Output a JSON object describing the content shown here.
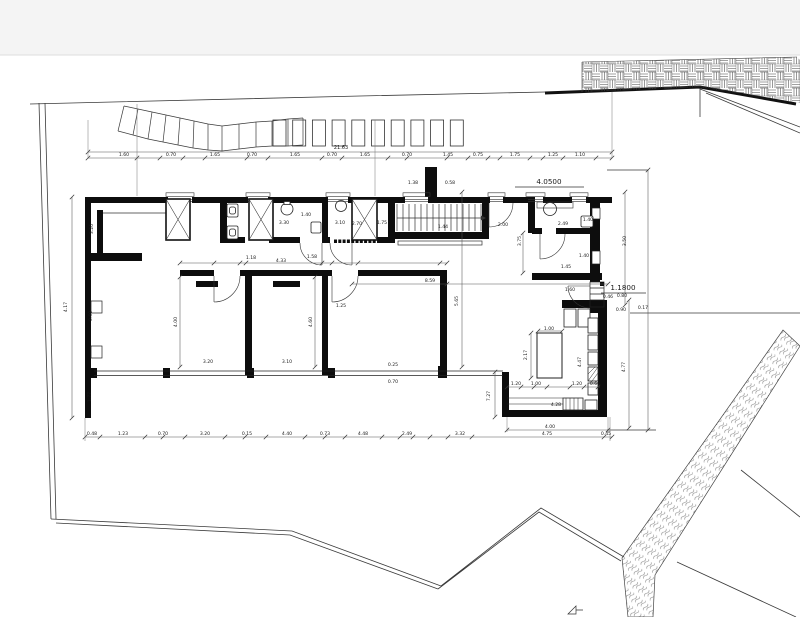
{
  "page": {
    "background": "#ffffff",
    "top_margin_color": "#f4f4f4"
  },
  "drawing": {
    "colors": {
      "wall_ink": "#0d0d0d",
      "thin_line": "#3a3a3a",
      "dim_line": "#555555",
      "hatch": "#666666"
    },
    "level_labels": [
      {
        "text": "4.0500",
        "x": 549,
        "y": 184
      },
      {
        "text": "1.1800",
        "x": 623,
        "y": 290
      }
    ],
    "overall_dimension": {
      "text": "21.63",
      "x": 341,
      "y": 149
    },
    "top_chain": {
      "y": 156,
      "labels": [
        {
          "x": 124,
          "t": "1.60"
        },
        {
          "x": 171,
          "t": "0.70"
        },
        {
          "x": 215,
          "t": "1.65"
        },
        {
          "x": 252,
          "t": "0.70"
        },
        {
          "x": 295,
          "t": "1.65"
        },
        {
          "x": 332,
          "t": "0.70"
        },
        {
          "x": 365,
          "t": "1.65"
        },
        {
          "x": 407,
          "t": "0.70"
        },
        {
          "x": 448,
          "t": "1.45"
        },
        {
          "x": 478,
          "t": "0.75"
        },
        {
          "x": 515,
          "t": "1.75"
        },
        {
          "x": 553,
          "t": "1.25"
        },
        {
          "x": 580,
          "t": "1.10"
        }
      ]
    },
    "bottom_chain": {
      "y": 435,
      "labels": [
        {
          "x": 92,
          "t": "0.48"
        },
        {
          "x": 123,
          "t": "1.23"
        },
        {
          "x": 163,
          "t": "0.70"
        },
        {
          "x": 205,
          "t": "3.20"
        },
        {
          "x": 247,
          "t": "0.15"
        },
        {
          "x": 287,
          "t": "4.40"
        },
        {
          "x": 325,
          "t": "0.73"
        },
        {
          "x": 363,
          "t": "4.48"
        },
        {
          "x": 407,
          "t": "2.49"
        },
        {
          "x": 460,
          "t": "3.32"
        },
        {
          "x": 547,
          "t": "4.75"
        },
        {
          "x": 606,
          "t": "0.45"
        }
      ]
    },
    "secondary_bottom_dimension": {
      "text": "4.00",
      "x": 550,
      "y": 428
    },
    "dim_labels": [
      {
        "t": "4.17",
        "x": 67,
        "y": 307,
        "r": -90
      },
      {
        "t": "3.20",
        "x": 93,
        "y": 229,
        "r": -90
      },
      {
        "t": "0.60",
        "x": 92,
        "y": 316,
        "r": -90
      },
      {
        "t": "1.77",
        "x": 91,
        "y": 397,
        "r": -90
      },
      {
        "t": "4.00",
        "x": 177,
        "y": 322,
        "r": -90
      },
      {
        "t": "4.60",
        "x": 312,
        "y": 322,
        "r": -90
      },
      {
        "t": "3.20",
        "x": 208,
        "y": 363
      },
      {
        "t": "3.10",
        "x": 287,
        "y": 363
      },
      {
        "t": "1.25",
        "x": 341,
        "y": 307
      },
      {
        "t": "1.18",
        "x": 251,
        "y": 259
      },
      {
        "t": "4.33",
        "x": 281,
        "y": 262
      },
      {
        "t": "1.58",
        "x": 312,
        "y": 258
      },
      {
        "t": "3.30",
        "x": 284,
        "y": 224
      },
      {
        "t": "3.10",
        "x": 340,
        "y": 224
      },
      {
        "t": "1.40",
        "x": 306,
        "y": 216
      },
      {
        "t": "2.70",
        "x": 357,
        "y": 225
      },
      {
        "t": "1.75",
        "x": 382,
        "y": 224
      },
      {
        "t": "1.44",
        "x": 443,
        "y": 228
      },
      {
        "t": "1.38",
        "x": 413,
        "y": 184
      },
      {
        "t": "0.58",
        "x": 450,
        "y": 184
      },
      {
        "t": "2.00",
        "x": 503,
        "y": 226
      },
      {
        "t": "2.49",
        "x": 563,
        "y": 225
      },
      {
        "t": "1.40",
        "x": 588,
        "y": 221
      },
      {
        "t": "3.75",
        "x": 521,
        "y": 241,
        "r": -90
      },
      {
        "t": "1.45",
        "x": 566,
        "y": 268
      },
      {
        "t": "1.40",
        "x": 584,
        "y": 257
      },
      {
        "t": "3.50",
        "x": 626,
        "y": 241,
        "r": -90
      },
      {
        "t": "1.60",
        "x": 570,
        "y": 291
      },
      {
        "t": "0.46",
        "x": 608,
        "y": 298
      },
      {
        "t": "0.80",
        "x": 622,
        "y": 297
      },
      {
        "t": "0.90",
        "x": 621,
        "y": 311
      },
      {
        "t": "0.17",
        "x": 643,
        "y": 309
      },
      {
        "t": "8.59",
        "x": 430,
        "y": 282
      },
      {
        "t": "5.65",
        "x": 458,
        "y": 301,
        "r": -90
      },
      {
        "t": "7.27",
        "x": 490,
        "y": 396,
        "r": -90
      },
      {
        "t": "4.47",
        "x": 581,
        "y": 362,
        "r": -90
      },
      {
        "t": "4.77",
        "x": 625,
        "y": 367,
        "r": -90
      },
      {
        "t": "1.00",
        "x": 549,
        "y": 330
      },
      {
        "t": "2.17",
        "x": 527,
        "y": 355,
        "r": -90
      },
      {
        "t": "1.20",
        "x": 516,
        "y": 385
      },
      {
        "t": "1.00",
        "x": 536,
        "y": 385
      },
      {
        "t": "1.20",
        "x": 577,
        "y": 385
      },
      {
        "t": "0.60",
        "x": 595,
        "y": 385
      },
      {
        "t": "4.28",
        "x": 556,
        "y": 406
      },
      {
        "t": "0.25",
        "x": 393,
        "y": 366
      },
      {
        "t": "0.70",
        "x": 393,
        "y": 383
      }
    ]
  }
}
